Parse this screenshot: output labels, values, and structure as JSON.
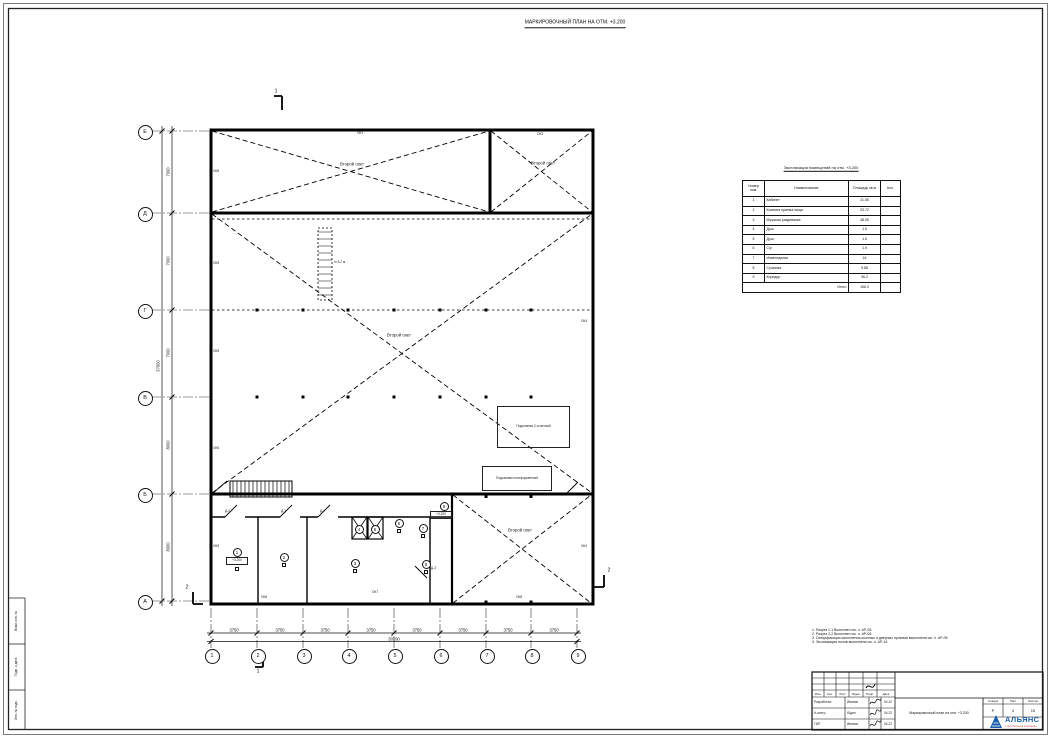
{
  "sheet": {
    "title": "МАРКИРОВОЧНЫЙ ПЛАН НА ОТМ. +3.200"
  },
  "plan": {
    "second_light": "Второй свет",
    "ladder_note": "h=3.2 м",
    "elevation_mark": "+3.200",
    "lift_two_post": "Подъемник 2-стоечный",
    "lift_platform": "Подъемник платформенный",
    "row_axes": [
      "Е",
      "Д",
      "Г",
      "В",
      "Б",
      "А"
    ],
    "col_axes": [
      "1",
      "2",
      "3",
      "4",
      "5",
      "6",
      "7",
      "8",
      "9"
    ],
    "row_dims": [
      "7000",
      "7000",
      "7000",
      "8000",
      "8000"
    ],
    "row_total": "37000",
    "col_dims": [
      "3750",
      "3750",
      "3750",
      "3750",
      "3750",
      "3750",
      "3750",
      "3750"
    ],
    "col_total": "30000",
    "section_marks": {
      "s1": "1",
      "s2": "2"
    },
    "openings": {
      "ok1": "ОК1",
      "ok3": "ОК3",
      "ok4": "ОК4",
      "ok5": "ОК5",
      "ok6": "ОК6",
      "ok7": "ОК7",
      "ok8": "ОК8",
      "d1": "Д-1",
      "d2": "Д-2",
      "d3": "Д-3",
      "d7": "Д-7"
    },
    "room_tags": [
      "1",
      "2",
      "3",
      "4",
      "5",
      "6",
      "7",
      "8",
      "9"
    ]
  },
  "explication": {
    "title": "Экспликация помещений на отм. +3.200",
    "headers": [
      "Номер пом.",
      "Наименование",
      "Площадь кв.м",
      "Кол."
    ],
    "rows": [
      {
        "n": "1",
        "name": "Кабинет",
        "area": "21.55"
      },
      {
        "n": "2",
        "name": "Комната приема пищи",
        "area": "23.72"
      },
      {
        "n": "3",
        "name": "Мужская раздевалка",
        "area": "48.05"
      },
      {
        "n": "4",
        "name": "Душ",
        "area": "1.5"
      },
      {
        "n": "5",
        "name": "Душ",
        "area": "1.5"
      },
      {
        "n": "6",
        "name": "С/у",
        "area": "1.9"
      },
      {
        "n": "7",
        "name": "Инвентарная",
        "area": "16"
      },
      {
        "n": "8",
        "name": "Сушилка",
        "area": "5.88"
      },
      {
        "n": "9",
        "name": "Коридор",
        "area": "36.2"
      }
    ],
    "total_label": "Итого",
    "total_value": "156.3"
  },
  "notes": {
    "items": [
      "1. Разрез 1-1 Выполнен см. л. АР-05.",
      "2. Разрез 2-2 Выполнен см. л. АР-06.",
      "3. Спецификация заполнения оконных и дверных проемов выполнена см. л. АР-09.",
      "4. Экспликация полов выполнена см. л. АР-10."
    ]
  },
  "titleblock": {
    "change_headers": [
      "Изм.",
      "Кол.",
      "Лист",
      "№док.",
      "Подп.",
      "Дата"
    ],
    "roles": [
      {
        "role": "Разработал",
        "name": "Иванов",
        "date": "04.22"
      },
      {
        "role": "Н.контр.",
        "name": "Юдин",
        "date": "04.22"
      },
      {
        "role": "ГИП",
        "name": "Иванов",
        "date": "04.22"
      }
    ],
    "stage_label": "Стадия",
    "sheet_label": "Лист",
    "sheets_label": "Листов",
    "stage": "Р",
    "sheet_no": "4",
    "sheets_total": "15",
    "doc_title": "Маркировочный план на отм. +3.200",
    "logo_name": "АЛЬЯНС",
    "logo_sub": "строительная компания",
    "logo_color": "#1c5fae"
  },
  "side_strip": {
    "cells": [
      "Взам. инв. №",
      "Подп. и дата",
      "Инв. № подл."
    ]
  }
}
